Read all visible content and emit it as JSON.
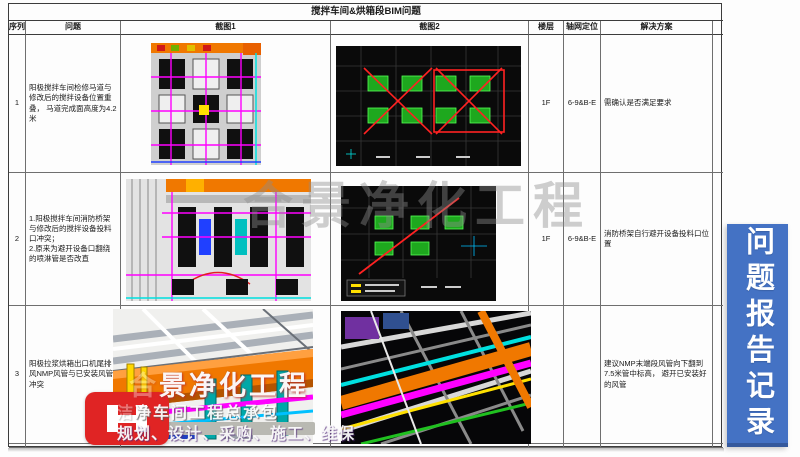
{
  "banner": {
    "text": "问题报告记录"
  },
  "watermark": {
    "text": "合景净化工程"
  },
  "table": {
    "title": "搅拌车间&烘箱段BIM问题",
    "headers": {
      "seq": "序列",
      "problem": "问题",
      "shot1": "截图1",
      "shot2": "截图2",
      "floor": "楼层",
      "axis": "轴网定位",
      "solution": "解决方案"
    },
    "rows": [
      {
        "seq": "1",
        "problem": "阳极搅拌车间检修马道与修改后的搅拌设备位置重叠， 马道完成面高度为4.2米",
        "floor": "1F",
        "axis": "6-9&B-E",
        "solution": "需确认是否满足要求"
      },
      {
        "seq": "2",
        "problem": "1.阳极搅拌车间消防桥架与修改后的搅拌设备投料口冲突；\n2.原来为避开设备口翻绕的喷淋管是否改直",
        "floor": "1F",
        "axis": "6-9&B-E",
        "solution": "消防桥架自行避开设备投料口位置"
      },
      {
        "seq": "3",
        "problem": "阳极拉浆烘箱出口机尾排风NMP风管与已安装风管冲突",
        "floor": "",
        "axis": "",
        "solution": "建议NMP末端段风管向下翻到7.5米管中标高， 避开已安装好的风管"
      }
    ]
  },
  "logo": {
    "icon": "ch-monogram-icon",
    "line1_faint": "合",
    "line1": "景净化工程",
    "line2_faint": "洁",
    "line2": "净车间工程总承包",
    "line3": "规划、设计、采购、施工、维保"
  },
  "colors": {
    "banner_blue": "#4472c4",
    "logo_red": "#e02424",
    "cad_orange": "#f07800",
    "cad_magenta": "#ff00ff",
    "cad_cyan": "#00e0e0",
    "cad_green": "#1ea81e",
    "mark_red": "#e02020"
  }
}
